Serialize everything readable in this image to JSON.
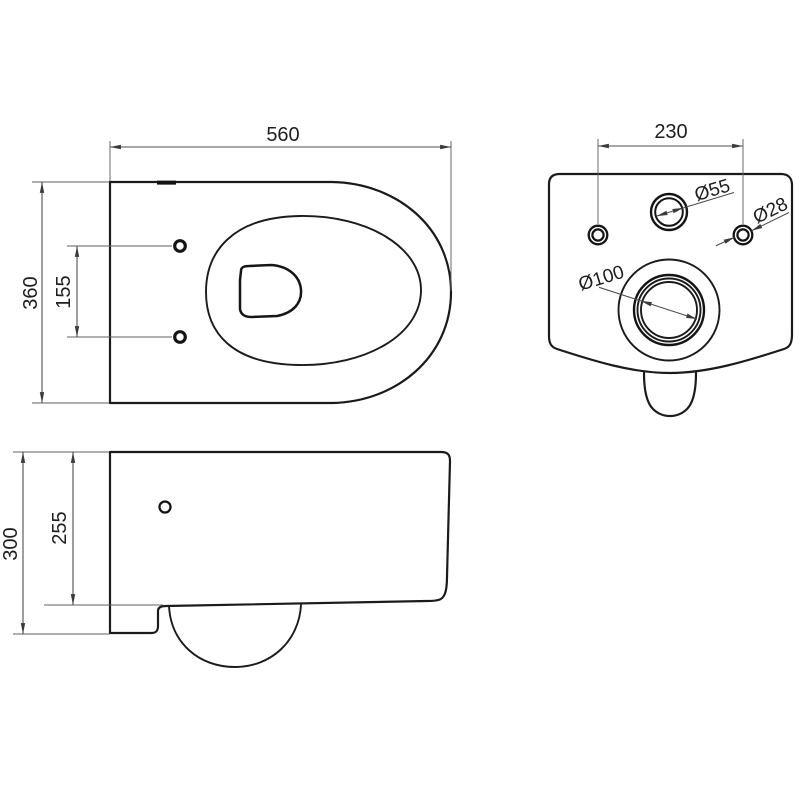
{
  "drawing": {
    "top_view": {
      "width": "560",
      "depth": "360",
      "seat_hole_spacing": "155"
    },
    "rear_view": {
      "mount_hole_spacing": "230",
      "water_inlet_diameter": "Ø55",
      "mount_hole_diameter": "Ø28",
      "waste_outlet_diameter": "Ø100"
    },
    "side_view": {
      "overall_height": "300",
      "body_height": "255"
    }
  },
  "colors": {
    "background": "#ffffff",
    "outline": "#1b1b1b",
    "dimension_line": "#4f4f4f",
    "label_text": "#1e1e1e"
  }
}
